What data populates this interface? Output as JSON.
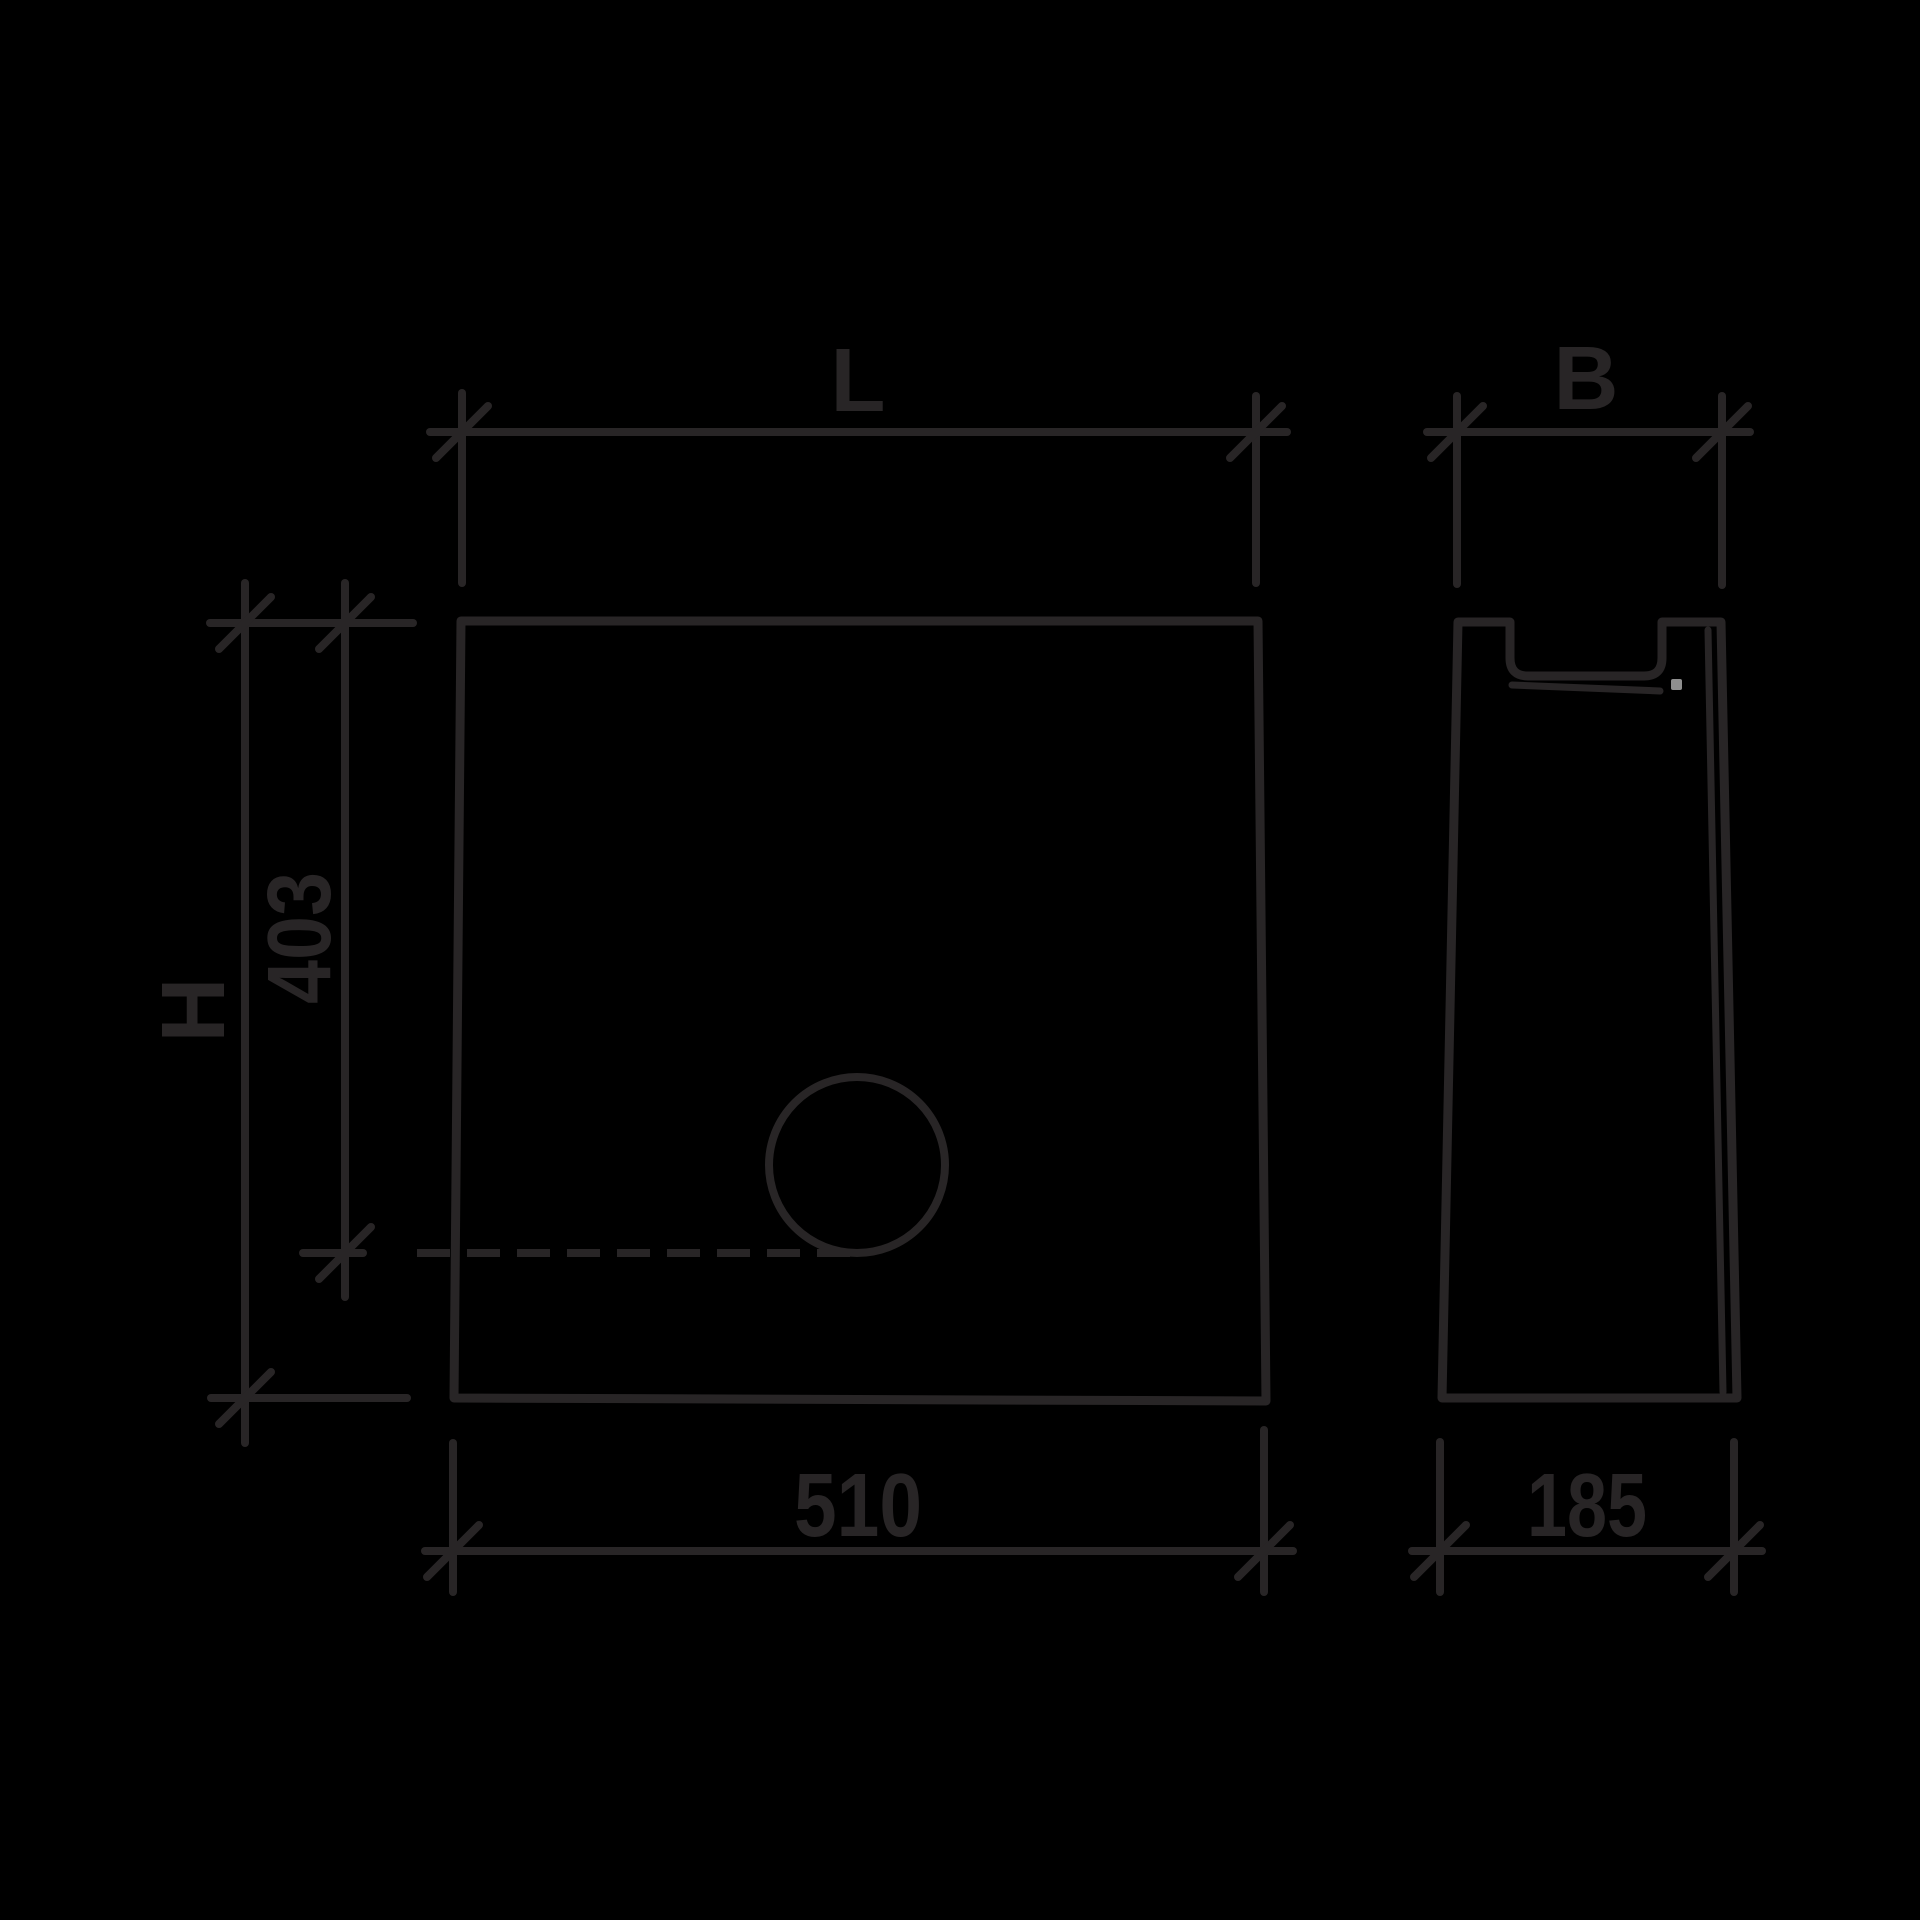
{
  "drawing": {
    "colors": {
      "background": "#000000",
      "line": "#282526",
      "artifact_dot": "#8f8f8f"
    },
    "labels": {
      "length_top": "L",
      "width_top": "B",
      "height_left": "H",
      "invert_depth_left": "403",
      "length_bottom": "510",
      "width_bottom": "185"
    }
  }
}
